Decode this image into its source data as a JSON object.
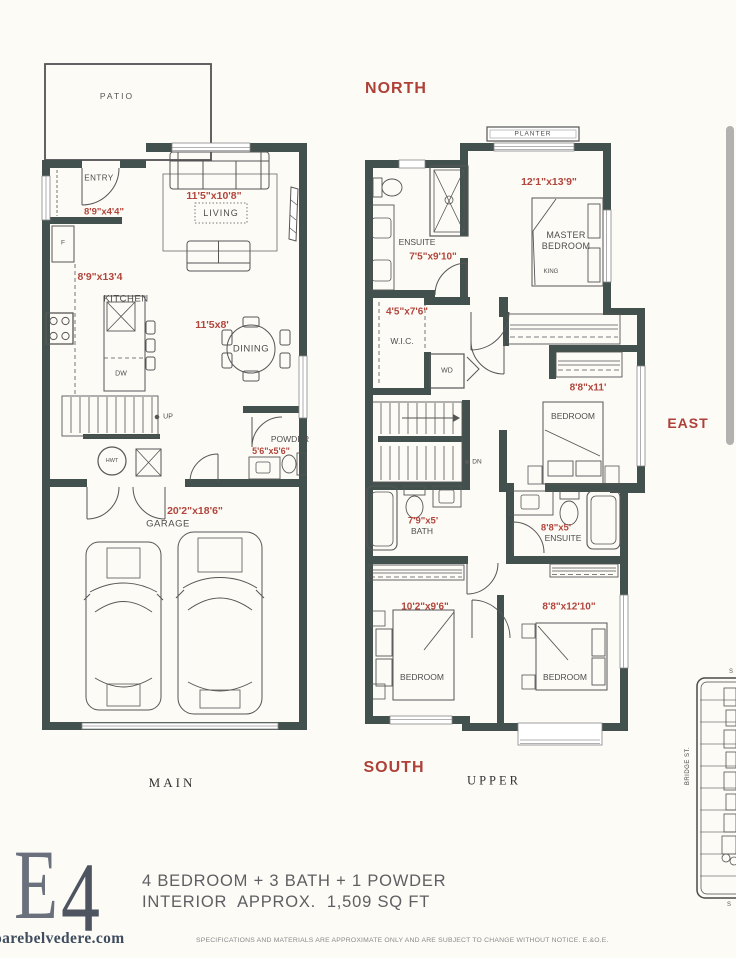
{
  "compass": {
    "north": "NORTH",
    "south": "SOUTH",
    "east": "EAST"
  },
  "main_floor": {
    "floor_label": "MAIN",
    "patio": "PATIO",
    "entry": "ENTRY",
    "entry_dim": "8'9\"x4'4\"",
    "living": "LIVING",
    "living_dim": "11'5\"x10'8\"",
    "kitchen": "KITCHEN",
    "kitchen_dim": "8'9\"x13'4",
    "fridge": "F",
    "dishwasher": "DW",
    "dining": "DINING",
    "dining_dim": "11'5x8'",
    "stairs_up": "UP",
    "hot_water_tank": "HWT",
    "powder": "POWDER",
    "powder_dim": "5'6\"x5'6\"",
    "garage": "GARAGE",
    "garage_dim": "20'2\"x18'6\""
  },
  "upper_floor": {
    "floor_label": "UPPER",
    "planter": "PLANTER",
    "master_bedroom": "MASTER BEDROOM",
    "master_dim": "12'1\"x13'9\"",
    "king": "KING",
    "ensuite": "ENSUITE",
    "ensuite_dim": "7'5\"x9'10\"",
    "wic": "W.I.C.",
    "wic_dim": "4'5\"x7'6\"",
    "washer_dryer": "WD",
    "bedroom2": "BEDROOM",
    "bedroom2_dim": "8'8\"x11'",
    "bath": "BATH",
    "bath_dim": "7'9\"x5'",
    "ensuite2": "ENSUITE",
    "ensuite2_dim": "8'8\"x5'",
    "bedroom3": "BEDROOM",
    "bedroom3_dim": "10'2\"x9'6\"",
    "bedroom4": "BEDROOM",
    "bedroom4_dim": "8'8\"x12'10\"",
    "stairs_dn": "DN"
  },
  "site_map": {
    "street": "BRIDGE ST.",
    "fragment_top": "S",
    "fragment_bottom": "S"
  },
  "footer": {
    "logo_e": "E",
    "logo_4": "4",
    "summary_line1": "4 BEDROOM + 3 BATH + 1 POWDER",
    "summary_line2": "INTERIOR  APPROX.  1,509 SQ FT",
    "website": "oarebelvedere.com",
    "disclaimer": "SPECIFICATIONS AND MATERIALS ARE APPROXIMATE ONLY AND ARE SUBJECT TO CHANGE WITHOUT NOTICE. E.&O.E."
  },
  "colors": {
    "wall": "#42514d",
    "dim_red": "#b2453c",
    "logo": "#5a6270"
  }
}
